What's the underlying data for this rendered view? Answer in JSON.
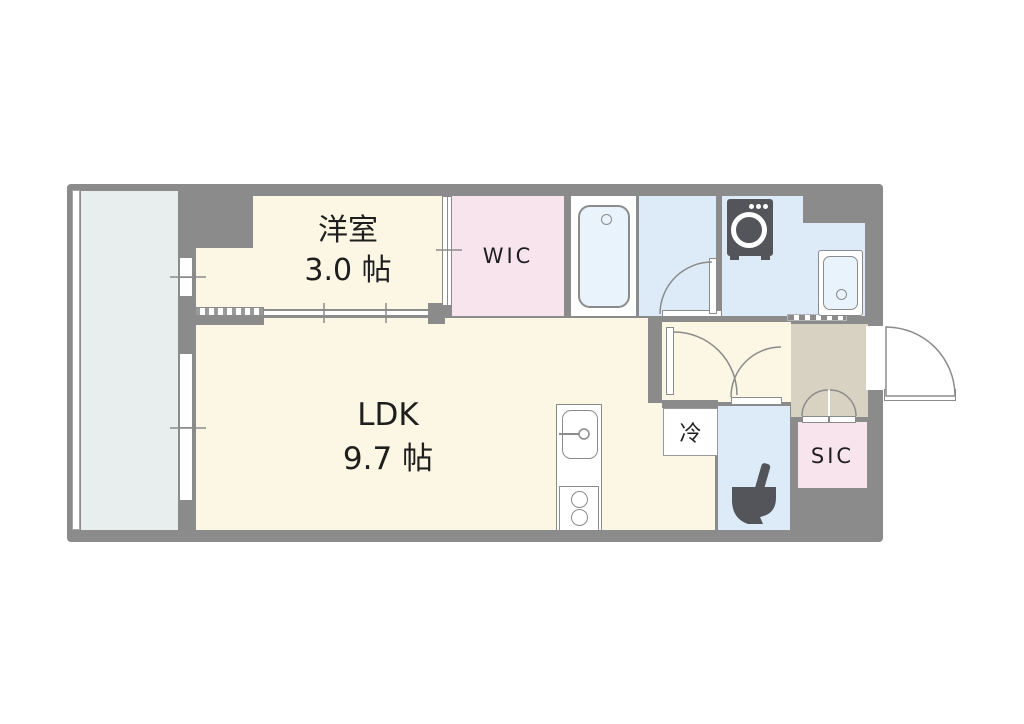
{
  "floorplan": {
    "type": "apartment-floor-plan-1LDK",
    "rooms": {
      "western": {
        "name": "洋室",
        "size": "3.0 帖"
      },
      "ldk": {
        "name": "LDK",
        "size": "9.7 帖"
      },
      "wic": {
        "label": "WIC"
      },
      "sic": {
        "label": "SIC"
      },
      "refrigerator": {
        "label": "冷"
      }
    },
    "fixtures": [
      "bathtub",
      "washing-machine",
      "vanity-sink",
      "kitchen-sink",
      "gas-stove",
      "toilet",
      "balcony-window-small",
      "balcony-window-large",
      "entrance-door",
      "sliding-doors",
      "bifold-closet-doors",
      "hinged-doors",
      "balcony"
    ],
    "colors": {
      "wall": "#8b8b8b",
      "room_cream": "#fbf7e4",
      "closet_pink": "#f8e4ed",
      "wet_area_blue": "#dcebf7",
      "bathtub_blue": "#e9f3fb",
      "balcony_gray": "#e8edee",
      "entrance_beige": "#d8d2c2",
      "fixture_dark": "#53555b",
      "text": "#1e1e1e"
    }
  }
}
